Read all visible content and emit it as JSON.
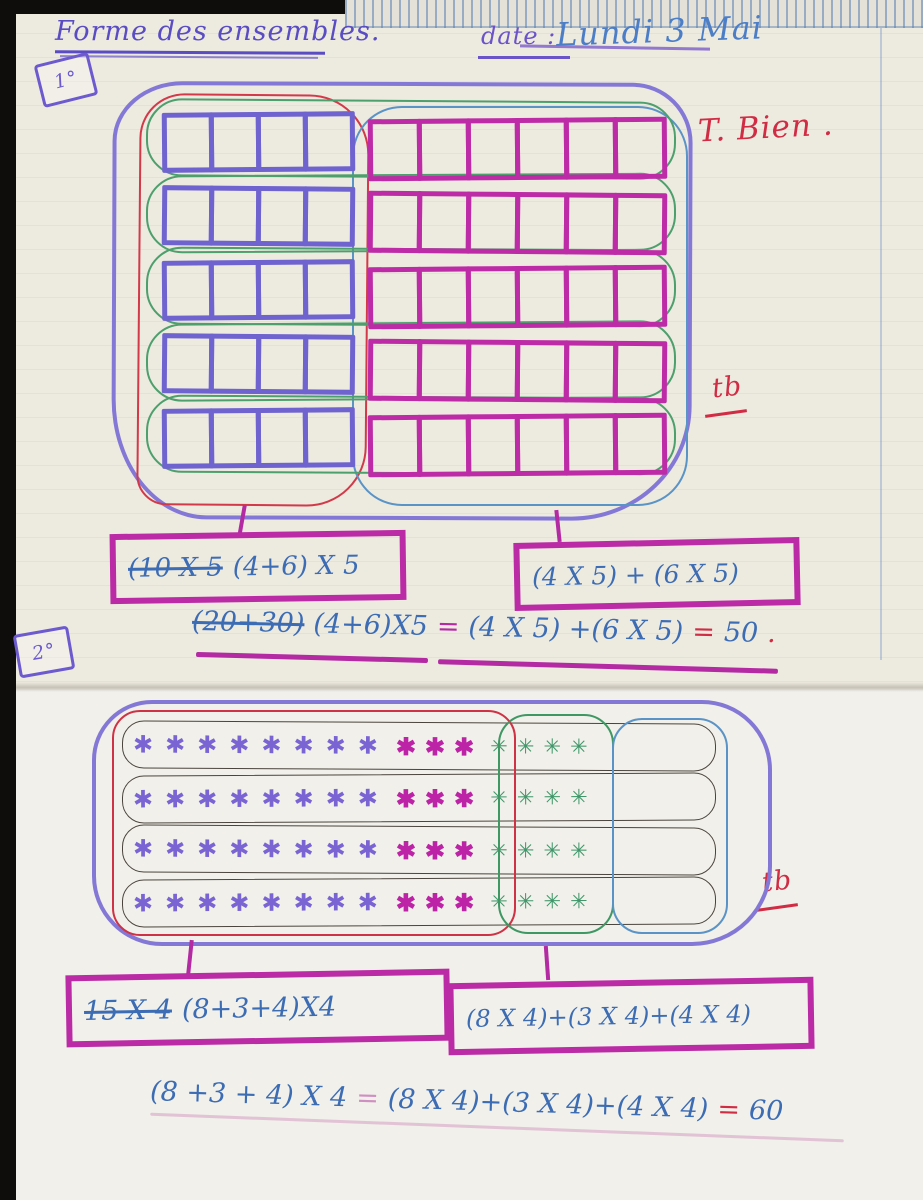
{
  "header": {
    "title": "Forme des ensembles.",
    "date_label": "date :",
    "date_value": "Lundi 3 Mai"
  },
  "stamps": {
    "first": "1°",
    "second": "2°"
  },
  "marks": {
    "tres_bien": "T. Bien .",
    "tb": "tb",
    "ink_red": "#d02c44",
    "ink_purple": "#5a4cc2",
    "ink_blue": "#3c6cb4",
    "ink_magenta": "#b32aa3",
    "ink_green": "#3f9764"
  },
  "figure1": {
    "left_grid": {
      "rows": 5,
      "cols": 4,
      "color": "#6f63cf"
    },
    "right_grid": {
      "rows": 5,
      "cols": 6,
      "color": "#be2ba7"
    },
    "box_left": {
      "struck": "(10 X 5",
      "kept": "(4+6) X 5"
    },
    "box_right": {
      "text": "(4 X 5) + (6 X 5)"
    },
    "eq": {
      "struck": "(20+30)",
      "lhs": "(4+6)X5",
      "eq1": "=",
      "rhs": "(4 X 5) +(6 X 5)",
      "eq2": "=",
      "result": "50",
      "period": "."
    }
  },
  "figure2": {
    "rows": 4,
    "purple_per_row": 8,
    "magenta_per_row": 3,
    "green_per_row": 4,
    "star_glyph": "✱",
    "green_star_glyph": "✳",
    "box_left": {
      "struck": "15 X 4",
      "kept": "(8+3+4)X4"
    },
    "box_right": {
      "text": "(8 X 4)+(3 X 4)+(4 X 4)"
    },
    "eq": {
      "lhs": "(8 +3 + 4) X 4",
      "eq1": "=",
      "rhs": "(8 X 4)+(3 X 4)+(4 X 4)",
      "eq2": "=",
      "result": "60"
    }
  }
}
